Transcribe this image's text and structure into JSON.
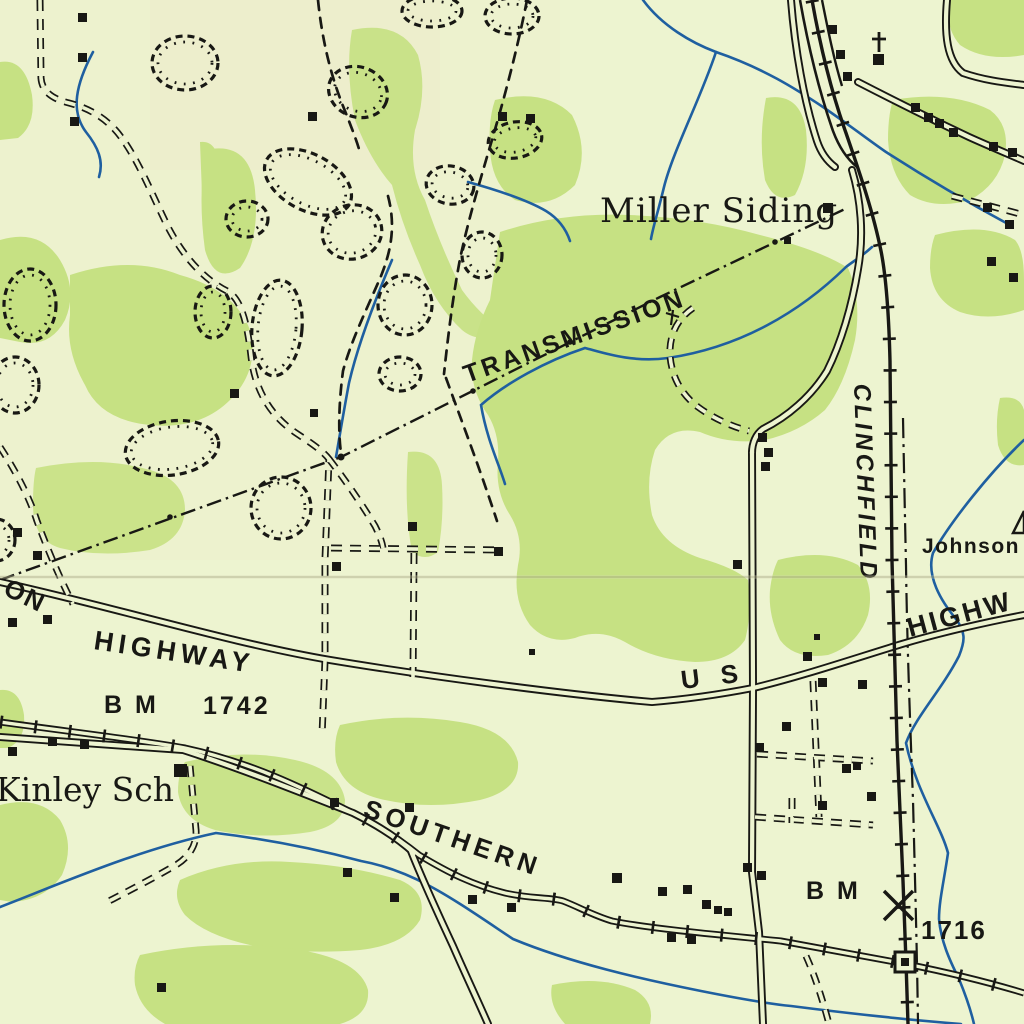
{
  "map": {
    "kind": "topographic-map-excerpt",
    "labels": {
      "miller_siding": "Miller Siding",
      "transmission_line": "TRANSMISSION",
      "clinchfield_railroad": "CLINCHFIELD",
      "johnson": "Johnson",
      "highway_right_partial": "HIGHW",
      "highway_left_word_partial": "ON",
      "highway_left": "HIGHWAY",
      "benchmark_left_prefix": "B M",
      "benchmark_left_elevation": "1742",
      "kinley_school": "Kinley Sch",
      "southern_railway": "SOUTHERN",
      "us_route": "U S",
      "benchmark_right_prefix": "B M",
      "benchmark_right_elevation": "1716"
    },
    "colors": {
      "paper": "#edf4d0",
      "woodland": "#c6e183",
      "water": "#1f5fa0",
      "ink": "#181814",
      "crease": "#8e8e6a"
    },
    "symbols": {
      "church": "church-cross-icon",
      "school": "building-square-icon",
      "station": "open-square-station-icon",
      "benchmark": "benchmark-x-icon",
      "triangulation": "triangle-icon",
      "strip_pit": "hachured-depression-icon",
      "transmission": "dash-dot-pole-line-icon"
    }
  }
}
